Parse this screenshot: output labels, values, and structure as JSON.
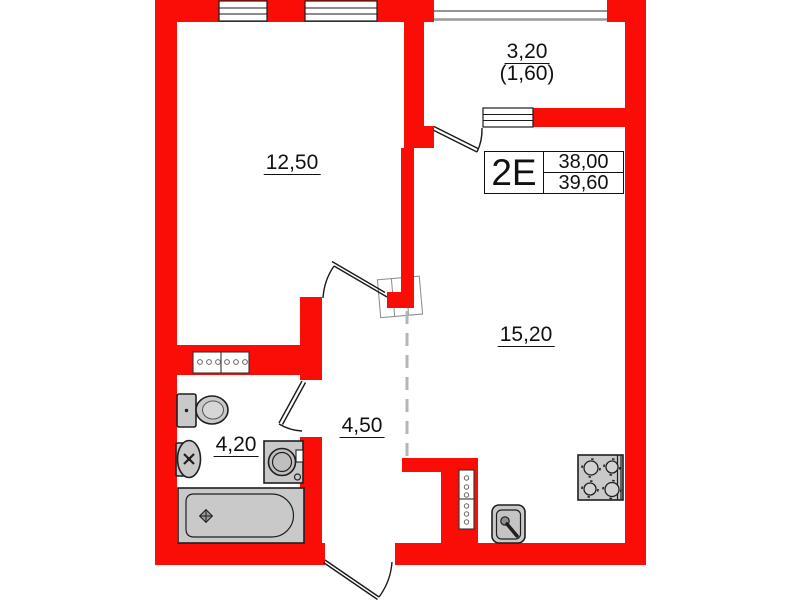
{
  "unit_box": {
    "unit_label": "2E",
    "total_area": "38,00",
    "total_area_with_balcony": "39,60"
  },
  "rooms": [
    {
      "key": "living-room",
      "area": "12,50"
    },
    {
      "key": "balcony",
      "area": "3,20",
      "area_reduced": "(1,60)"
    },
    {
      "key": "kitchen-living-room",
      "area": "15,20"
    },
    {
      "key": "hallway",
      "area": "4,50"
    },
    {
      "key": "bathroom",
      "area": "4,20"
    }
  ],
  "colors": {
    "wall": "#f90d06",
    "fixture_fill": "#c9c9c9",
    "fixture_stroke": "#1f1f1f",
    "line": "#1a1a1a",
    "zone_dash": "#b5b5b5",
    "background": "#ffffff"
  },
  "symbols": [
    "window",
    "balcony-glazing",
    "balcony-door",
    "room-door",
    "bathroom-door",
    "entrance-door",
    "wardrobe",
    "zone-boundary-dashed",
    "ventilation-duct",
    "toilet",
    "wash-basin",
    "washing-machine",
    "bathtub",
    "kitchen-sink",
    "cooktop"
  ]
}
